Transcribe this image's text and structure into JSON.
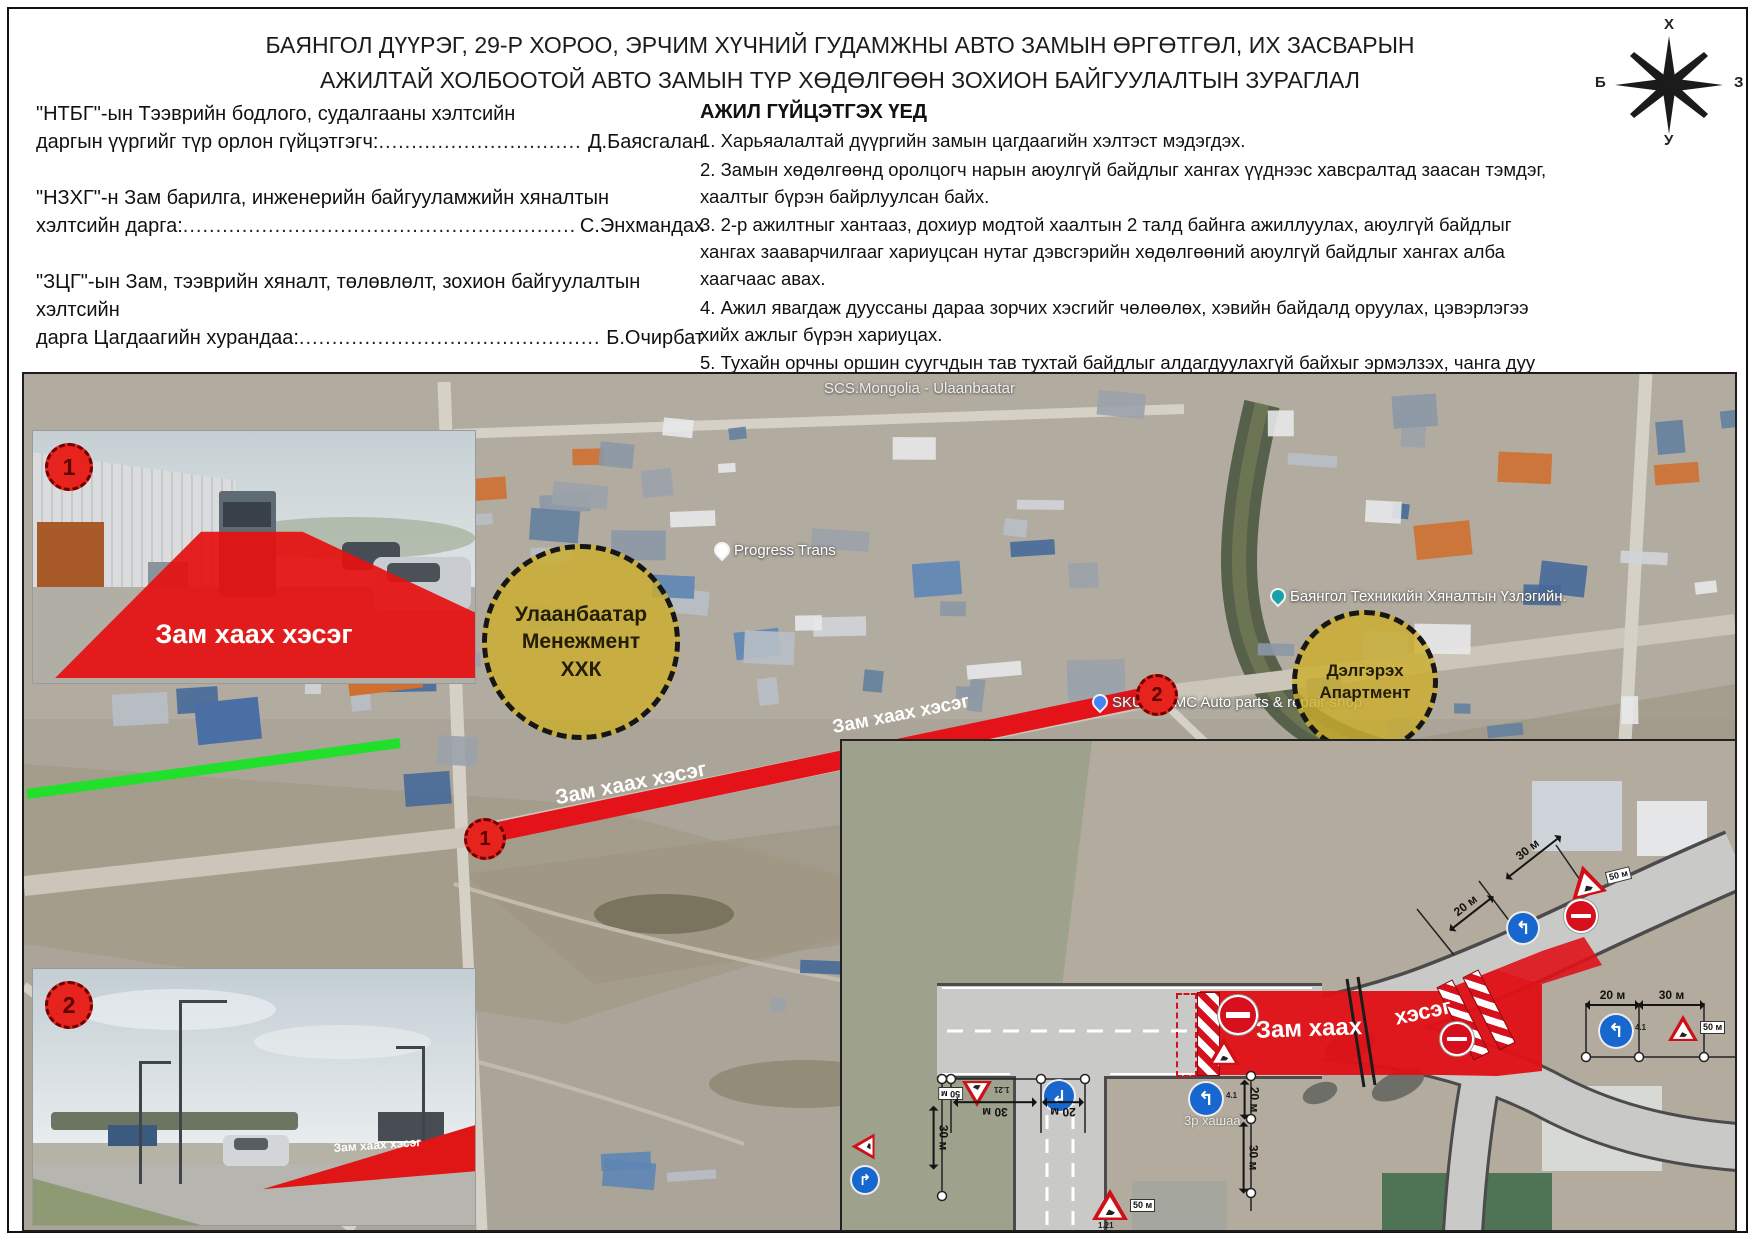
{
  "title": {
    "line1": "БАЯНГОЛ ДҮҮРЭГ, 29-Р ХОРОО, ЭРЧИМ ХҮЧНИЙ ГУДАМЖНЫ АВТО ЗАМЫН ӨРГӨТГӨЛ, ИХ ЗАСВАРЫН",
    "line2": "АЖИЛТАЙ ХОЛБООТОЙ АВТО ЗАМЫН ТҮР ХӨДӨЛГӨӨН ЗОХИОН БАЙГУУЛАЛТЫН ЗУРАГЛАЛ"
  },
  "compass": {
    "n": "Х",
    "s": "У",
    "w": "Б",
    "e": "З"
  },
  "officials": [
    {
      "line1": "\"НТБГ\"-ын Тээврийн бодлого, судалгааны хэлтсийн",
      "label": "даргын үүргийг түр орлон гүйцэтгэгч:",
      "name": "Д.Баясгалан"
    },
    {
      "line1": "\"НЗХГ\"-н Зам барилга, инженерийн байгууламжийн хяналтын",
      "label": "хэлтсийн дарга:",
      "name": "С.Энхмандах"
    },
    {
      "line1": "\"ЗЦГ\"-ын Зам, тээврийн хяналт, төлөвлөлт, зохион байгуулалтын хэлтсийн",
      "label": "дарга Цагдаагийн хурандаа:",
      "name": "Б.Очирбат"
    }
  ],
  "schedule": {
    "heading": "Зам засварын хугацаа:",
    "start": "Эхлэх хугацаа : 2025 оны 09 сарын 19 өдөр 23:00 цаг",
    "end": "Дуусах хугацаа : 2025 оны 09 сарын 21 өдөр 06:00 цаг"
  },
  "work": {
    "heading": "АЖИЛ ГҮЙЦЭТГЭХ ҮЕД",
    "items": [
      "1. Харьяалалтай дүүргийн замын цагдаагийн хэлтэст мэдэгдэх.",
      "2. Замын хөдөлгөөнд оролцогч нарын аюулгүй байдлыг хангах үүднээс хавсралтад заасан тэмдэг, хаалтыг бүрэн байрлуулсан байх.",
      "3. 2-р ажилтныг хантааз, дохиур модтой хаалтын 2 талд байнга ажиллуулах, аюулгүй байдлыг хангах зааварчилгааг хариуцсан нутаг дэвсгэрийн хөдөлгөөний аюулгүй байдлыг хангах алба хаагчаас авах.",
      "4. Ажил явагдаж дууссаны дараа зорчих хэсгийг чөлөөлөх, хэвийн байдалд оруулах, цэвэрлэгээ хийх ажлыг бүрэн хариуцах.",
      "5. Тухайн орчны оршин суугчдын тав тухтай байдлыг алдагдуулахгүй байхыг эрмэлзэх, чанга дуу чимээ гаргахгүй, дуут дохио өгөхийг хориглоно.",
      "6. Тухайн орчны оршин суугч, иргэд, албан байгууллагад албан ёсоор хийгдэх ажлын талаар мэдэгдэх.",
      "7. Замын хөдөлгөөний аюулгүй байдлын тухай хууль, Замын хөдөлгөөний дүрэм зөрчихгүй үйл ажиллагаа явуулах."
    ]
  },
  "signoff": {
    "label": "Зааварчилгаа хүлээн авсан:"
  },
  "leaders": {
    "dots": "...................................................................................................................................................................................................................................................................................................."
  },
  "map": {
    "poi_scs": "SCS.Mongolia - Ulaanbaatar",
    "poi_progress": "Progress Trans",
    "poi_bayangol": "Баянгол Техникийн Хяналтын Үзлэгийн.",
    "poi_skulls": "SKULLS MC Auto parts & repair shop",
    "zone1": "Улаанбаатар Менежмент ХХК",
    "zone2": "Дэлгэрэх Апартмент",
    "closure1": "Зам хаах хэсэг",
    "closure2": "Зам хаах хэсэг",
    "point1": "1",
    "point2": "2"
  },
  "photos": [
    {
      "badge": "1",
      "label": "Зам хаах хэсэг"
    },
    {
      "badge": "2",
      "label": "Зам хаах хэсэг"
    }
  ],
  "diagram": {
    "closure_a": "Зам хаах",
    "closure_b": "хэсэг",
    "m20": "20 м",
    "m30": "30 м",
    "plate": "50 м",
    "code_tri": "1.21",
    "code_blue": "4.1",
    "gate": "3р хашаа"
  },
  "colors": {
    "closure_red": "#e41219",
    "zone_yellow": "#ccae2a",
    "route_green": "#21df2b"
  }
}
